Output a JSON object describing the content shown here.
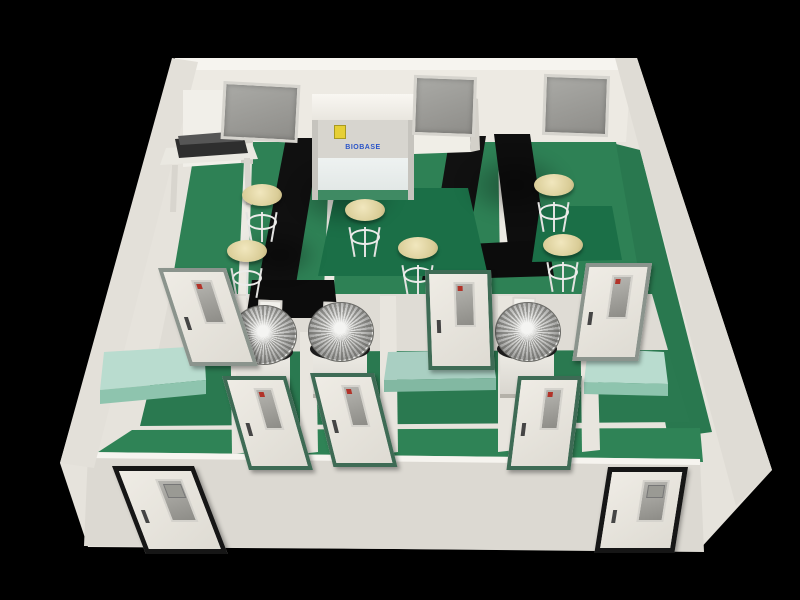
{
  "meta": {
    "description": "3D cutaway rendering of a laboratory suite: white walls, green epoxy floors, black lab benches, biosafety cabinet, round stools, radial fan units and multiple doors on a black background",
    "background": "#000000"
  },
  "cabinet": {
    "logo_text": "BIOBASE",
    "sticker": "biohazard-warning"
  },
  "palette": {
    "wall": "#e6e3dc",
    "wall_shadow": "#d6d3cc",
    "wall_highlight": "#f6f4ef",
    "floor_green": "#2e8155",
    "island_green": "#1b6f47",
    "bench_black": "#101010",
    "counter_teal": "#b9dccf",
    "stool_beige": "#e7dcab",
    "window_gray": "#9a9a96",
    "door_frame_green": "#3e6b55",
    "door_frame_gray": "#8b948d",
    "door_frame_black": "#161616",
    "logo_blue": "#2b55c8",
    "sticker_yellow": "#e6cf35"
  },
  "geometry": {
    "polys": [
      {
        "name": "outer-shell",
        "fill": "#e6e3dc",
        "points": "175,58 637,58 772,470 698,551 88,547 60,463"
      },
      {
        "name": "back-wall-top-highlight",
        "fill": "#f6f4ef",
        "points": "175,58 637,58 635,72 177,72"
      },
      {
        "name": "back-wall-face",
        "fill": "#edeae3",
        "points": "181,70 631,70 626,142 186,142"
      },
      {
        "name": "upper-lab-floor",
        "fill": "#2e8155",
        "points": "196,142 616,142 652,294 170,294"
      },
      {
        "name": "right-corridor-floor",
        "fill": "#29784f",
        "points": "616,144 640,150 712,432 668,438"
      },
      {
        "name": "mid-wall-band",
        "fill": "#dfdcd5",
        "points": "170,294 652,294 668,350 158,352"
      },
      {
        "name": "mid-rooms-floor",
        "fill": "#2a7950",
        "points": "158,352 668,350 690,422 140,426"
      },
      {
        "name": "corridor-floor",
        "fill": "#2f8356",
        "points": "132,430 700,428 703,462 92,456"
      },
      {
        "name": "front-wall",
        "fill": "#dcd9d2",
        "points": "88,452 700,459 704,552 84,546"
      },
      {
        "name": "front-wall-highlight",
        "fill": "#f6f4ef",
        "points": "88,452 700,459 700,465 88,458"
      },
      {
        "name": "left-outer-wall",
        "fill": "#e3e0d9",
        "points": "172,58 198,62 94,468 60,463"
      },
      {
        "name": "right-outer-wall",
        "fill": "#dfdcd5",
        "points": "615,58 637,58 772,470 736,506"
      },
      {
        "name": "partition-upper-left",
        "fill": "#eceae3",
        "points": "244,160 252,160 248,294 238,294"
      },
      {
        "name": "partition-upper-center",
        "fill": "#eceae3",
        "points": "330,142 338,142 334,290 324,290"
      },
      {
        "name": "partition-upper-right",
        "fill": "#eceae3",
        "points": "498,140 506,140 510,268 500,268"
      },
      {
        "name": "partition-1",
        "fill": "#e8e5de",
        "points": "230,296 246,296 252,452 232,454"
      },
      {
        "name": "partition-2",
        "fill": "#e8e5de",
        "points": "300,332 316,332 318,452 300,454"
      },
      {
        "name": "partition-3",
        "fill": "#e8e5de",
        "points": "380,296 396,296 398,452 380,454"
      },
      {
        "name": "partition-4",
        "fill": "#e8e5de",
        "points": "498,296 514,296 516,450 498,452"
      },
      {
        "name": "partition-5",
        "fill": "#e8e5de",
        "points": "580,296 596,296 600,450 582,452"
      },
      {
        "name": "bench-left-vertical",
        "fill": "#101010",
        "points": "286,138 320,138 296,284 258,284"
      },
      {
        "name": "bench-left-return",
        "fill": "#0c0c0c",
        "points": "252,280 334,280 338,318 246,318"
      },
      {
        "name": "bench-right-vertical-a",
        "fill": "#111111",
        "points": "450,136 486,136 462,282 426,282"
      },
      {
        "name": "bench-right-vertical-b",
        "fill": "#0e0e0e",
        "points": "494,134 530,134 546,242 508,246"
      },
      {
        "name": "bench-right-return",
        "fill": "#0c0c0c",
        "points": "428,246 548,240 554,276 422,280"
      },
      {
        "name": "island-table-center",
        "fill": "#1b6f47",
        "points": "336,188 468,188 488,276 318,276"
      },
      {
        "name": "island-table-right",
        "fill": "#1b6f47",
        "points": "540,206 612,206 622,260 532,262"
      },
      {
        "name": "counter-left-top",
        "fill": "#b9dccf",
        "points": "104,352 204,346 206,380 100,390"
      },
      {
        "name": "counter-left-front",
        "fill": "#8ec4ae",
        "points": "100,390 206,380 206,394 100,404"
      },
      {
        "name": "counter-right-top",
        "fill": "#b9dccf",
        "points": "588,348 664,352 668,384 584,382"
      },
      {
        "name": "counter-right-front",
        "fill": "#8ec4ae",
        "points": "584,382 668,384 668,396 584,394"
      },
      {
        "name": "counter-center-top",
        "fill": "#a9cfc2",
        "points": "388,352 492,350 496,378 384,380"
      },
      {
        "name": "counter-center-front",
        "fill": "#82b8a2",
        "points": "384,380 496,378 496,390 384,392"
      },
      {
        "name": "workstation-cabinet",
        "fill": "#f1efe9",
        "points": "183,90 241,90 241,163 183,167"
      },
      {
        "name": "workstation-cabinet-side",
        "fill": "#d0cdc6",
        "points": "241,90 253,94 253,164 241,163"
      },
      {
        "name": "workstation-table-top",
        "fill": "#eae8e1",
        "points": "166,148 252,143 258,159 160,165"
      },
      {
        "name": "workstation-equipment",
        "fill": "#2e2e2e",
        "points": "175,139 243,134 248,153 179,158"
      },
      {
        "name": "workstation-equipment-top",
        "fill": "#565656",
        "points": "178,136 240,131 243,141 180,145"
      },
      {
        "name": "workstation-table-leg-l",
        "fill": "#d8d5ce",
        "points": "172,165 178,165 176,212 170,212"
      },
      {
        "name": "workstation-table-leg-r",
        "fill": "#d8d5ce",
        "points": "244,158 250,158 252,205 246,205"
      },
      {
        "name": "booth-right-of-cabinet",
        "fill": "#f0eee7",
        "points": "414,95 468,95 471,152 414,154"
      },
      {
        "name": "booth-side-face",
        "fill": "#d4d1ca",
        "points": "468,95 478,99 480,150 471,152"
      }
    ],
    "shadows": [
      {
        "name": "floor-shadow-1",
        "x": 290,
        "y": 160,
        "w": 110,
        "h": 70
      },
      {
        "name": "floor-shadow-2",
        "x": 460,
        "y": 150,
        "w": 110,
        "h": 70
      },
      {
        "name": "floor-shadow-3",
        "x": 240,
        "y": 230,
        "w": 80,
        "h": 50
      }
    ],
    "windows": [
      {
        "name": "back-window-1",
        "x": 222,
        "y": 83,
        "w": 71,
        "h": 52,
        "rot": 3
      },
      {
        "name": "back-window-2",
        "x": 413,
        "y": 76,
        "w": 57,
        "h": 54,
        "rot": 2
      },
      {
        "name": "back-window-3",
        "x": 543,
        "y": 75,
        "w": 60,
        "h": 55,
        "rot": 2
      }
    ],
    "vents": [
      {
        "name": "wall-vent-1",
        "x": 258,
        "y": 300
      },
      {
        "name": "wall-vent-2",
        "x": 323,
        "y": 302
      },
      {
        "name": "wall-vent-3",
        "x": 512,
        "y": 297
      }
    ],
    "fans": [
      {
        "name": "fan-unit-1",
        "x": 231,
        "y": 305
      },
      {
        "name": "fan-unit-2",
        "x": 308,
        "y": 302
      },
      {
        "name": "fan-unit-3",
        "x": 495,
        "y": 302
      }
    ],
    "stools": [
      {
        "name": "stool-1",
        "x": 242,
        "y": 184
      },
      {
        "name": "stool-2",
        "x": 227,
        "y": 240
      },
      {
        "name": "stool-3",
        "x": 345,
        "y": 199
      },
      {
        "name": "stool-4",
        "x": 398,
        "y": 237
      },
      {
        "name": "stool-5",
        "x": 534,
        "y": 174
      },
      {
        "name": "stool-6",
        "x": 543,
        "y": 234
      }
    ],
    "doors": [
      {
        "name": "interior-door-1",
        "type": "interior",
        "frame": "gray",
        "x": 158,
        "y": 268,
        "w": 60,
        "h": 90,
        "skew": 18
      },
      {
        "name": "interior-door-2",
        "type": "interior",
        "frame": "green",
        "x": 222,
        "y": 376,
        "w": 56,
        "h": 86,
        "skew": 16
      },
      {
        "name": "interior-door-3",
        "type": "interior",
        "frame": "green",
        "x": 310,
        "y": 373,
        "w": 56,
        "h": 86,
        "skew": 14
      },
      {
        "name": "interior-door-4",
        "type": "interior",
        "frame": "green",
        "x": 425,
        "y": 270,
        "w": 58,
        "h": 92,
        "skew": 2
      },
      {
        "name": "interior-door-5",
        "type": "interior",
        "frame": "green",
        "x": 518,
        "y": 376,
        "w": 56,
        "h": 86,
        "skew": -7
      },
      {
        "name": "interior-door-6",
        "type": "interior",
        "frame": "gray",
        "x": 586,
        "y": 263,
        "w": 58,
        "h": 90,
        "skew": -8
      },
      {
        "name": "exterior-door-left",
        "type": "exterior",
        "frame": "black",
        "x": 112,
        "y": 466,
        "w": 72,
        "h": 78,
        "skew": 21
      },
      {
        "name": "exterior-door-right",
        "type": "exterior",
        "frame": "black",
        "x": 608,
        "y": 467,
        "w": 70,
        "h": 76,
        "skew": -9
      }
    ]
  }
}
